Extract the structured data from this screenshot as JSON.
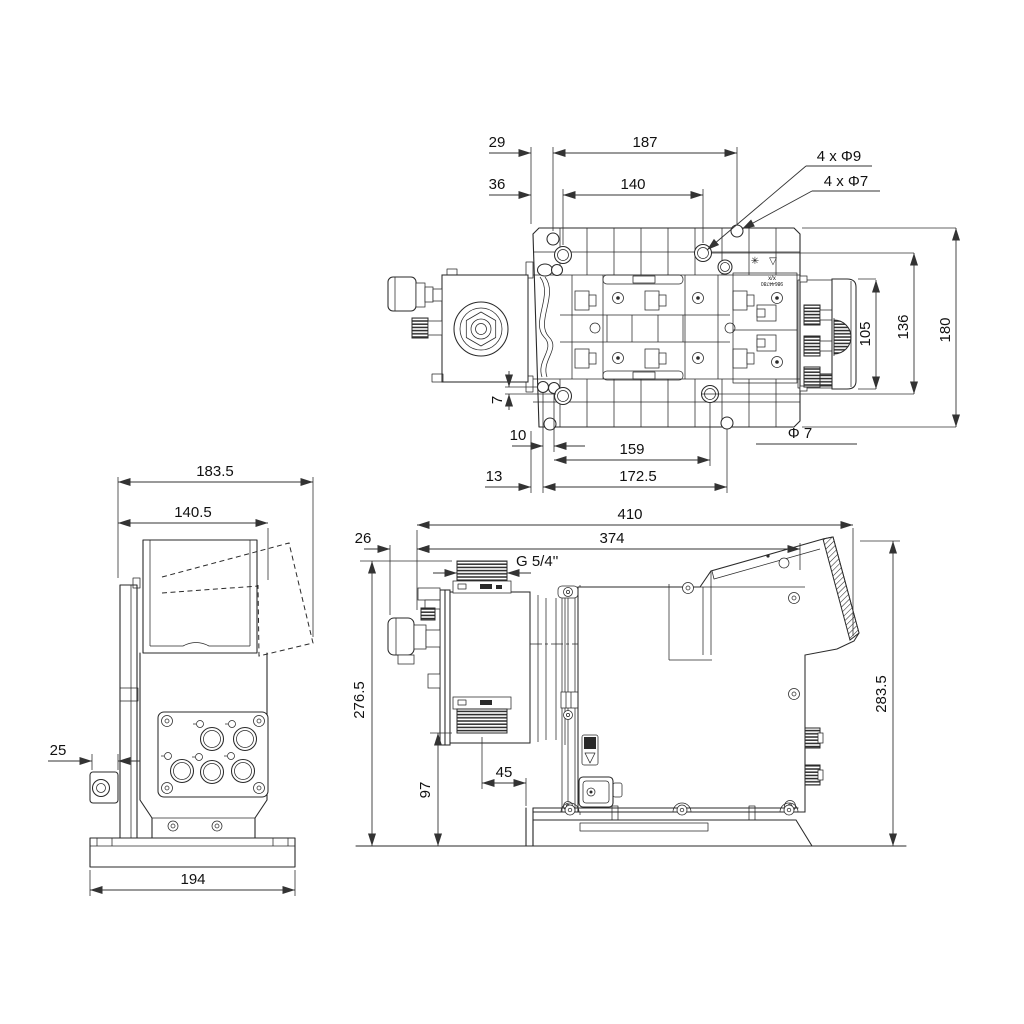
{
  "top": {
    "d29": "29",
    "d187": "187",
    "d36": "36",
    "d140": "140",
    "holes_phi9": "4 x Φ9",
    "holes_phi7": "4 x Φ7",
    "d105": "105",
    "d136": "136",
    "d180": "180",
    "d7": "7",
    "d10": "10",
    "d159": "159",
    "phi7_note": "Φ 7",
    "d13": "13",
    "d172_5": "172.5",
    "label_xx": "x/x",
    "label_code": "98644780",
    "icons": {
      "gear_badge": "✳",
      "warning_badge": "▽"
    }
  },
  "side": {
    "d183_5": "183.5",
    "d140_5": "140.5",
    "d25": "25",
    "d194": "194"
  },
  "front": {
    "d410": "410",
    "d374": "374",
    "d26": "26",
    "thread": "G 5/4''",
    "d276_5": "276.5",
    "d97": "97",
    "d45": "45",
    "d283_5": "283.5"
  }
}
